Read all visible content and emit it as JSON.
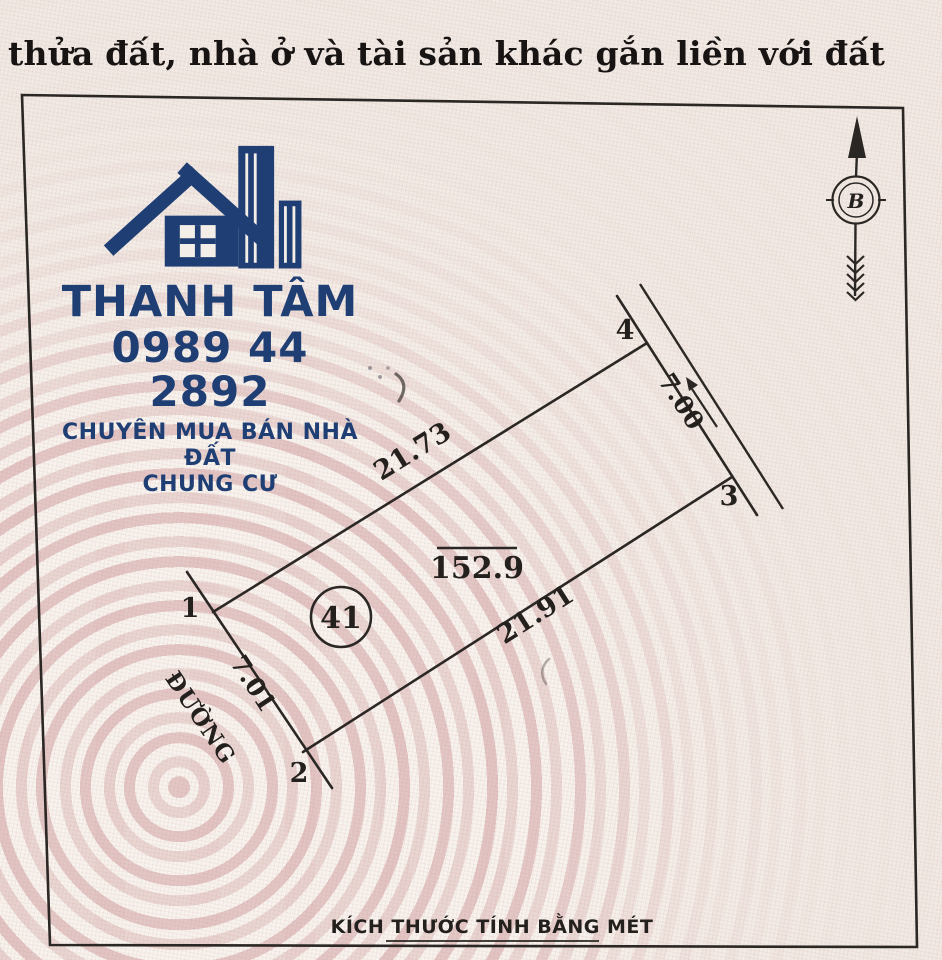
{
  "document": {
    "title_fragment": "thửa đất, nhà ở và tài sản khác gắn liền với đất"
  },
  "watermark": {
    "brand": "THANH TÂM",
    "phone": "0989 44 2892",
    "tagline_line1": "CHUYÊN MUA BÁN NHÀ ĐẤT",
    "tagline_line2": "CHUNG CƯ",
    "brand_color": "#1e3e74"
  },
  "compass": {
    "north_letter": "B"
  },
  "parcel": {
    "number": "41",
    "area_m2": "152.9",
    "road_label": "ĐƯỜNG",
    "corner_labels": [
      "1",
      "2",
      "3",
      "4"
    ],
    "side_lengths": {
      "side_1_4": "21.73",
      "side_2_3": "21.91",
      "side_1_2": "7.01",
      "side_3_4": "7.00"
    },
    "unit_note": "KÍCH THƯỚC TÍNH BẰNG MÉT"
  },
  "colors": {
    "ink": "#2b2724",
    "paper": "#f2ebe4",
    "pattern_pink": "#dcb3b6",
    "brand_navy": "#1e3e74"
  }
}
